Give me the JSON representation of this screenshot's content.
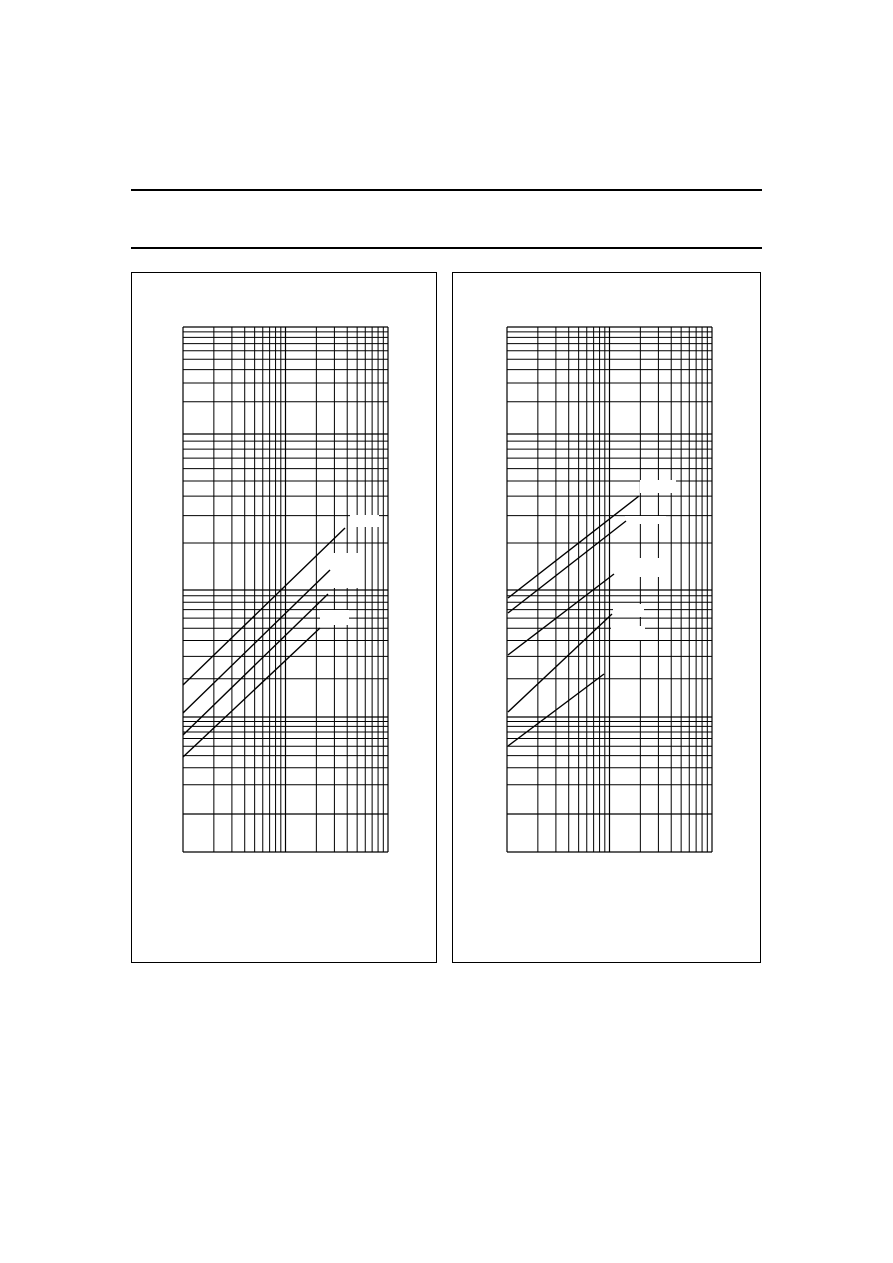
{
  "page": {
    "width": 893,
    "height": 1263,
    "background": "#ffffff",
    "ink": "#000000"
  },
  "header": {
    "rules": [
      {
        "x": 131,
        "y": 189,
        "width": 631,
        "height": 2
      },
      {
        "x": 131,
        "y": 247,
        "width": 631,
        "height": 2
      }
    ]
  },
  "figures": [
    {
      "id": "figure-1",
      "frame": {
        "x": 131,
        "y": 272,
        "width": 306,
        "height": 691
      },
      "grid": {
        "x_decade_bounds": [
          183,
          285.5,
          388
        ],
        "y_decade_bounds": [
          327,
          434,
          590,
          717,
          814
        ],
        "y_frame_bottom": 852,
        "minor_values": [
          2,
          3,
          4,
          5,
          6,
          7,
          8,
          9
        ],
        "line_width": 1,
        "border_width": 1.2
      },
      "curves": [
        {
          "x1": 183,
          "y1": 685,
          "x2": 345,
          "y2": 528
        },
        {
          "x1": 183,
          "y1": 713,
          "x2": 330,
          "y2": 570
        },
        {
          "x1": 183,
          "y1": 735,
          "x2": 328,
          "y2": 594
        },
        {
          "x1": 183,
          "y1": 757,
          "x2": 320,
          "y2": 628
        }
      ],
      "curve_width": 1.4,
      "label_patches": [
        {
          "x": 350,
          "y": 515,
          "width": 29,
          "height": 12
        },
        {
          "x": 328,
          "y": 553,
          "width": 33,
          "height": 35
        },
        {
          "x": 320,
          "y": 610,
          "width": 29,
          "height": 15
        }
      ]
    },
    {
      "id": "figure-2",
      "frame": {
        "x": 452,
        "y": 272,
        "width": 309,
        "height": 691
      },
      "grid": {
        "x_decade_bounds": [
          507,
          609.5,
          712
        ],
        "y_decade_bounds": [
          327,
          434,
          590,
          717,
          814
        ],
        "y_frame_bottom": 852,
        "minor_values": [
          2,
          3,
          4,
          5,
          6,
          7,
          8,
          9
        ],
        "line_width": 1,
        "border_width": 1.2
      },
      "curves": [
        {
          "x1": 508,
          "y1": 598,
          "x2": 639,
          "y2": 496
        },
        {
          "x1": 508,
          "y1": 613,
          "x2": 626,
          "y2": 521
        },
        {
          "x1": 508,
          "y1": 655,
          "x2": 614,
          "y2": 574
        },
        {
          "x1": 508,
          "y1": 712,
          "x2": 612,
          "y2": 614
        },
        {
          "x1": 508,
          "y1": 746,
          "x2": 604,
          "y2": 674
        }
      ],
      "curve_width": 1.4,
      "label_patches": [
        {
          "x": 640,
          "y": 480,
          "width": 36,
          "height": 13
        },
        {
          "x": 625,
          "y": 516,
          "width": 41,
          "height": 8
        },
        {
          "x": 636,
          "y": 558,
          "width": 23,
          "height": 19
        },
        {
          "x": 613,
          "y": 604,
          "width": 31,
          "height": 13
        },
        {
          "x": 611,
          "y": 626,
          "width": 34,
          "height": 14
        }
      ]
    }
  ],
  "chart_data": [
    {
      "type": "line",
      "title": "",
      "xlabel": "",
      "ylabel": "",
      "x_scale": "log",
      "y_scale": "log",
      "x_decades": 2,
      "y_decades": 5,
      "grid": "on",
      "tick_labels_visible": false,
      "legend": "none",
      "series": [
        {
          "name": "curve-1",
          "points_px": [
            [
              183,
              685
            ],
            [
              345,
              528
            ]
          ]
        },
        {
          "name": "curve-2",
          "points_px": [
            [
              183,
              713
            ],
            [
              330,
              570
            ]
          ]
        },
        {
          "name": "curve-3",
          "points_px": [
            [
              183,
              735
            ],
            [
              328,
              594
            ]
          ]
        },
        {
          "name": "curve-4",
          "points_px": [
            [
              183,
              757
            ],
            [
              320,
              628
            ]
          ]
        }
      ],
      "annotations": "four blank white label patches along the upper ends of the curves"
    },
    {
      "type": "line",
      "title": "",
      "xlabel": "",
      "ylabel": "",
      "x_scale": "log",
      "y_scale": "log",
      "x_decades": 2,
      "y_decades": 5,
      "grid": "on",
      "tick_labels_visible": false,
      "legend": "none",
      "series": [
        {
          "name": "curve-1",
          "points_px": [
            [
              508,
              598
            ],
            [
              639,
              496
            ]
          ]
        },
        {
          "name": "curve-2",
          "points_px": [
            [
              508,
              613
            ],
            [
              626,
              521
            ]
          ]
        },
        {
          "name": "curve-3",
          "points_px": [
            [
              508,
              655
            ],
            [
              614,
              574
            ]
          ]
        },
        {
          "name": "curve-4",
          "points_px": [
            [
              508,
              712
            ],
            [
              612,
              614
            ]
          ]
        },
        {
          "name": "curve-5",
          "points_px": [
            [
              508,
              746
            ],
            [
              604,
              674
            ]
          ]
        }
      ],
      "annotations": "five blank white label patches along the upper ends of the curves"
    }
  ]
}
